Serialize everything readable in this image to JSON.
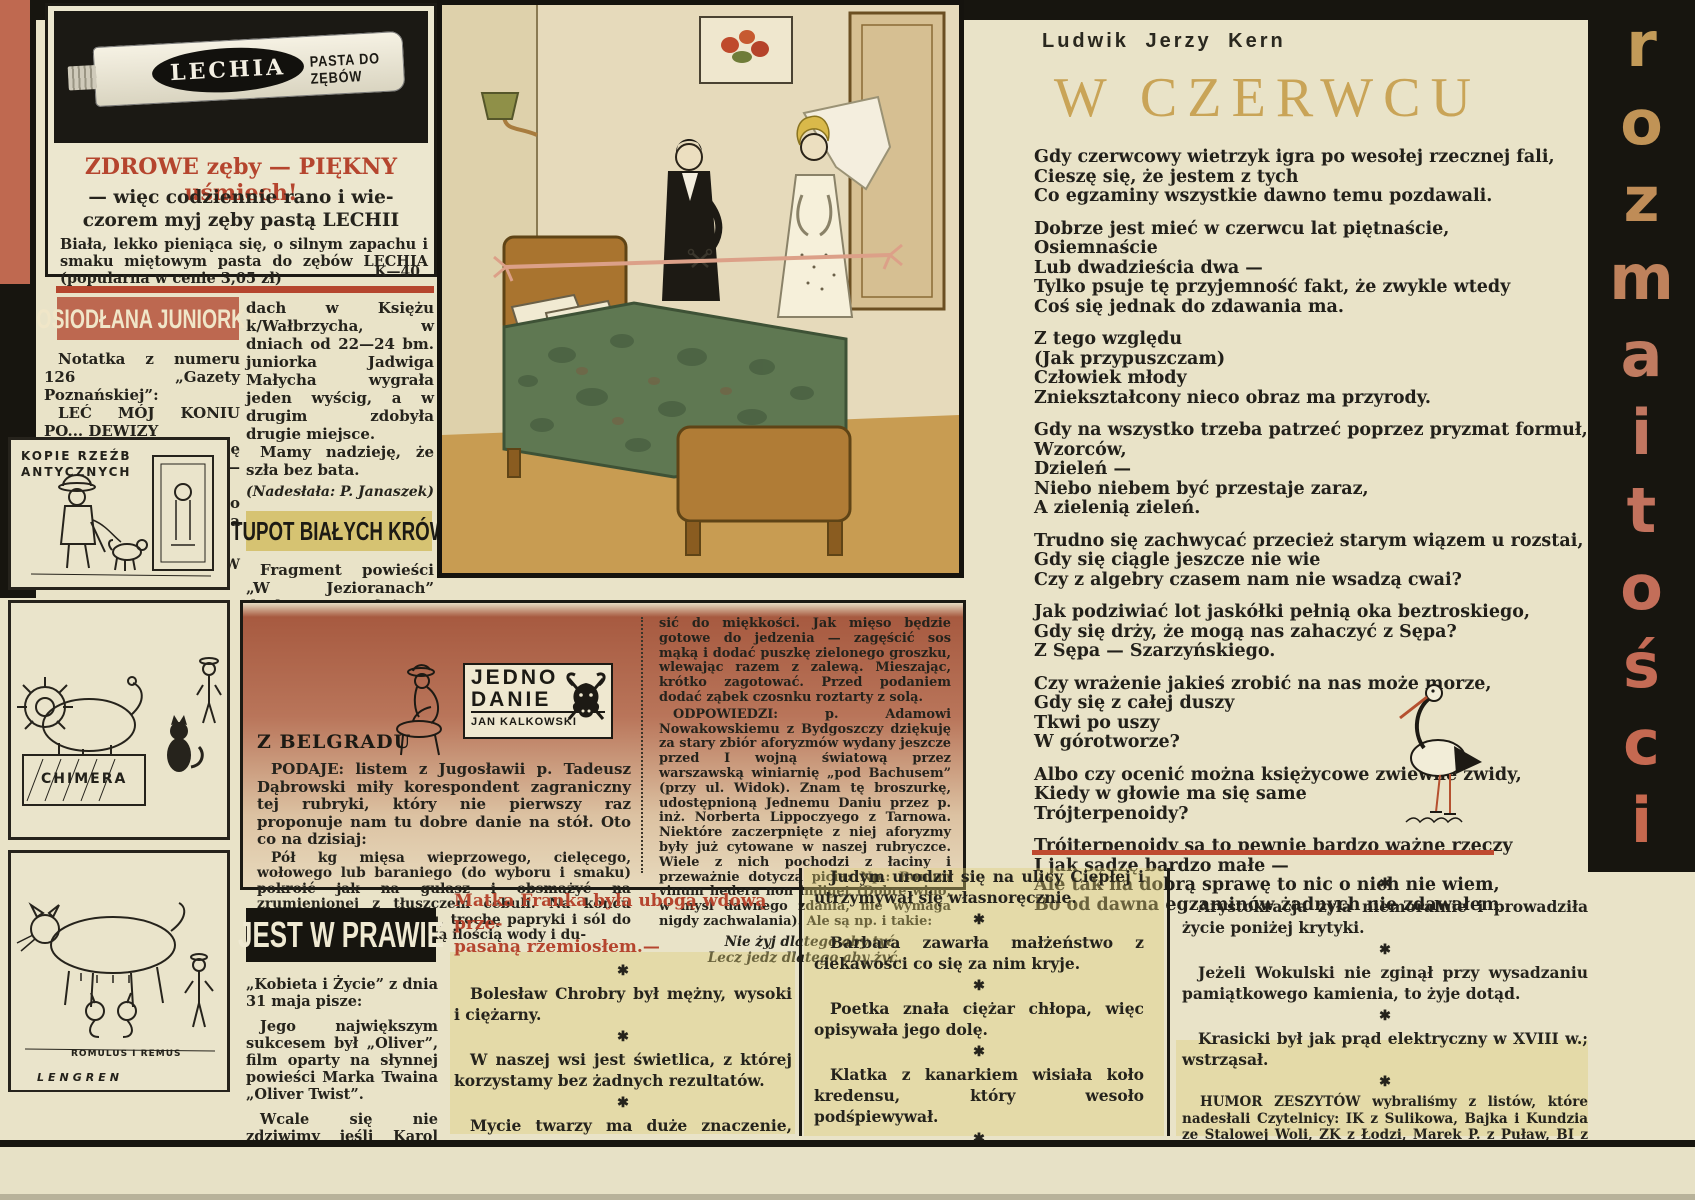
{
  "page": {
    "palette": {
      "cream": "#e9e3c8",
      "black": "#17150f",
      "terracotta": "#bf6950",
      "olive_yellow": "#d6c372",
      "red": "#b5452e",
      "gold_title": "#c9a457"
    }
  },
  "masthead": {
    "word": "rozmaitości",
    "letters": [
      "r",
      "o",
      "z",
      "m",
      "a",
      "i",
      "t",
      "o",
      "ś",
      "c",
      "i"
    ]
  },
  "ad": {
    "brand": "LECHIA",
    "product": "PASTA DO ZĘBÓW",
    "headline": "ZDROWE zęby — PIĘKNY uśmiech!",
    "subline": "— więc codziennie rano i wie-\nczorem myj zęby pastą LECHII",
    "body": "Biała, lekko pieniąca się, o silnym zapachu i smaku miętowym pasta do zębów LECHIA (popularna w cenie 3,05 zł)",
    "code": "K—40"
  },
  "osiodlana": {
    "title": "OSIODŁANA JUNIORKA",
    "col1": [
      "Notatka z numeru 126 „Gazety Poznańskiej”:",
      "LEĆ MÓJ KONIU PO... DEWIZY",
      "Dobrze spisują się konie — wychowankowie Zakładu Eksportowego w Poznaniu. Na ogólnopolskich zawo-"
    ],
    "artist_credit": "Rys. ZBIGNIEW LENGREN",
    "col2": [
      "dach w Księżu k/Wałbrzycha, w dniach od 22—24 bm. juniorka Jadwiga Małycha wygrała jeden wyścig, a w drugim zdobyła drugie miejsce.",
      "Mamy nadzieję, że szła bez bata."
    ],
    "credit": "(Nadesłała: P. Janaszek)"
  },
  "tupot": {
    "title": "TUPOT BIAŁYCH KRÓW",
    "paras": [
      "Fragment powieści „W Jezioranach” drukowany w dniu 5. VI. w „Dzienniku Ludowym”:",
      "Z mieszkania Jabłońskich dolatywał gwar, tupot krów, ożywione rozmowy, co rusz trzaskały drzwi...",
      "Widocznie krowy przyjmowały gości."
    ],
    "credit": "(Nadesłał: M. Waszak)"
  },
  "cartoons": {
    "panel1_caption": "KOPIE RZEŹB\nANTYCZNYCH",
    "panel2_caption": "CHIMERA",
    "panel3_caption": "ROMULUS I REMUS",
    "signature": "LENGREN"
  },
  "poem": {
    "author": "Ludwik Jerzy Kern",
    "title": "W CZERWCU",
    "stanzas": [
      "Gdy czerwcowy wietrzyk igra po wesołej rzecznej fali,\nCieszę się, że jestem z tych\nCo egzaminy wszystkie dawno temu pozdawali.",
      "Dobrze jest mieć w czerwcu lat piętnaście,\nOsiemnaście\nLub dwadzieścia dwa —\nTylko psuje tę przyjemność fakt, że zwykle wtedy\nCoś się jednak do zdawania ma.",
      "Z tego względu\n(Jak przypuszczam)\nCzłowiek młody\nZniekształcony nieco obraz ma przyrody.",
      "Gdy na wszystko trzeba patrzeć poprzez pryzmat formuł,\nWzorców,\nDzieleń —\nNiebo niebem być przestaje zaraz,\nA zielenią zieleń.",
      "Trudno się zachwycać przecież starym wiązem u rozstai,\nGdy się ciągle jeszcze nie wie\nCzy z algebry czasem nam nie wsadzą cwai?",
      "Jak podziwiać lot jaskółki pełnią oka beztroskiego,\nGdy się drży, że mogą nas zahaczyć z Sępa?\nZ Sępa — Szarzyńskiego.",
      "Czy wrażenie jakieś zrobić na nas może morze,\nGdy się z całej duszy\nTkwi po uszy\nW górotworze?",
      "Albo czy ocenić można księżycowe zwiewne zwidy,\nKiedy w głowie ma się same\nTrójterpenoidy?",
      "Trójterpenoidy są to pewnie bardzo ważne rzeczy\nI jak sądzę bardzo małe —\nAle tak na dobrą sprawę to nic o nich nie wiem,\nBo od dawna egzaminów żadnych nie zdawałem."
    ]
  },
  "jedno": {
    "logo_line1": "JEDNO",
    "logo_line2": "DANIE",
    "logo_line3": "JAN KALKOWSKI",
    "heading": "Z BELGRADU",
    "col1": [
      "PODAJE: listem z Jugosławii p. Tadeusz Dąbrowski miły korespondent zagraniczny tej rubryki, który nie pierwszy raz proponuje nam tu dobre danie na stół. Oto co na dzisiaj:",
      "Pół kg mięsa wieprzowego, cielęcego, wołowego lub baraniego (do wyboru i smaku) pokroić jak na gulasz i obsmażyć na zrumienionej z tłuszczem cebuli. Na końcu dodać szczyptę kminku, trochę papryki i sól do smaku. Podlać niewielką ilością wody i du-"
    ],
    "col2": [
      "sić do miękkości. Jak mięso będzie gotowe do jedzenia — zagęścić sos mąką i dodać puszkę zielonego groszku, wlewając razem z zalewą. Mieszając, krótko zagotować. Przed podaniem dodać ząbek czosnku roztarty z solą.",
      "ODPOWIEDZI: p. Adamowi Nowakowskiemu z Bydgoszczy dziękuję za stary zbiór aforyzmów wydany jeszcze przed I wojną światową przez warszawską winiarnię „pod Bachusem” (przy ul. Widok). Znam tę broszurkę, udostępnioną Jednemu Daniu przez p. inż. Norberta Lippoczyego z Tarnowa. Niektóre zaczerpnięte z niej aforyzmy były już cytowane w naszej rubryczce. Wiele z nich pochodzi z łaciny i przeważnie dotyczą picia: Np.: Bonum vinum hedera non indiget (Dobre wino, w myśl dawnego zdania, nie wymaga nigdy zachwalania). Ale są np. i takie:"
    ],
    "aphorism": "Nie żyj dlatego aby tyć,\nLecz jedz dlatego aby żyć."
  },
  "prawie": {
    "title": "JEST W PRAWIE",
    "paras": [
      "„Kobieta i Życie” z dnia 31 maja pisze:",
      "Jego największym sukcesem był „Oliver”, film oparty na słynnej powieści Marka Twaina „Oliver Twist”.",
      "Wcale się nie zdziwimy jeśli Karol Dickens wytoczy proces „Kobiecie i Życiu”."
    ],
    "credit": "(Nadesłał: M. Dąbrowski)"
  },
  "humor": {
    "asterisk": "✱",
    "colB_heading": "Matka Franka była ubogą wdową prze-\npasaną rzemiosłem.—",
    "colB": [
      "Bolesław Chrobry był mężny, wysoki i ciężarny.",
      "W naszej wsi jest świetlica, z której korzystamy bez żadnych rezultatów.",
      "Mycie twarzy ma duże znaczenie, ponieważ usuwa zmęczenie i smutek."
    ],
    "colC": [
      "Judym urodził się na ulicy Ciepłej i utrzymywał się własnoręcznie.",
      "Barbara zawarła małżeństwo z ciekawości co się za nim kryje.",
      "Poetka znała ciężar chłopa, więc opisywała jego dolę.",
      "Klatka z kanarkiem wisiała koło kredensu, który wesoło podśpiewywał.",
      "Zakonnicy zamiast odprawiać nabożeństwa sypiali w pucharach."
    ],
    "colD": [
      "Arystokracja żyła niemoralnie i prowadziła życie poniżej krytyki.",
      "Jeżeli Wokulski nie zginął przy wysadzaniu pamiątkowego kamienia, to żyje dotąd.",
      "Krasicki był jak prąd elektryczny w XVIII w.; wstrząsał."
    ],
    "footer": "HUMOR ZESZYTÓW wybraliśmy z listów, które nadesłali Czytelnicy: IK z Sulikowa, Bajka i Kundzia ze Stalowej Woli, ZK z Łodzi, Marek P. z Puław, BI z Działoszyc, mgr R. Gajczyk, H. Ch. Dziękujemy."
  }
}
